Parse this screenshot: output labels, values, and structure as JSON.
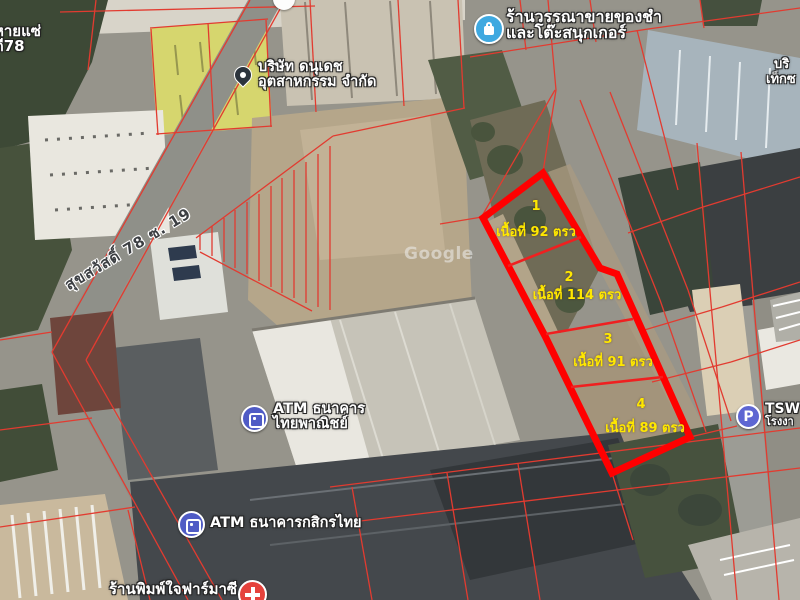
{
  "map_type": "satellite",
  "watermark": "Google",
  "road_label": "สุขสวัสดิ์ 78 ซ. 19",
  "plots": [
    {
      "number": "1",
      "area": "เนื้อที่ 92 ตรว"
    },
    {
      "number": "2",
      "area": "เนื้อที่ 114 ตรว"
    },
    {
      "number": "3",
      "area": "เนื้อที่ 91 ตรว"
    },
    {
      "number": "4",
      "area": "เนื้อที่ 89 ตรว"
    }
  ],
  "pois": {
    "grocery": {
      "icon": "store-icon",
      "line1": "ร้านวรรณาขายของชำ",
      "line2": "และโต๊ะสนุกเกอร์"
    },
    "company": {
      "icon": "place-pin-icon",
      "line1": "บริษัท ดนุเดช",
      "line2": "อุตสาหกรรม จำกัด"
    },
    "atm_scb": {
      "icon": "atm-icon",
      "line1": "ATM ธนาคาร",
      "line2": "ไทยพาณิชย์"
    },
    "atm_kbank": {
      "icon": "atm-icon",
      "line1": "ATM ธนาคารกสิกรไทย"
    },
    "pharmacy": {
      "icon": "pharmacy-icon",
      "line1": "ร้านพิมพ์ใจฟาร์มาซี"
    },
    "parking": {
      "icon": "parking-icon",
      "glyph": "P",
      "label": "TSW",
      "sub": "โรงงา"
    },
    "edge_left": {
      "line1": "หายแซ่",
      "line2": "ดี78"
    },
    "edge_right": {
      "line1": "บริ",
      "line2": "เท็กซ"
    }
  },
  "colors": {
    "plot_boundary": "#ff0000",
    "plot_divider": "#ef2020",
    "parcel_line": "#e23b30",
    "plot_label": "#ffe800",
    "poi_text": "#ffffff",
    "road_text": "#3c3f43"
  }
}
